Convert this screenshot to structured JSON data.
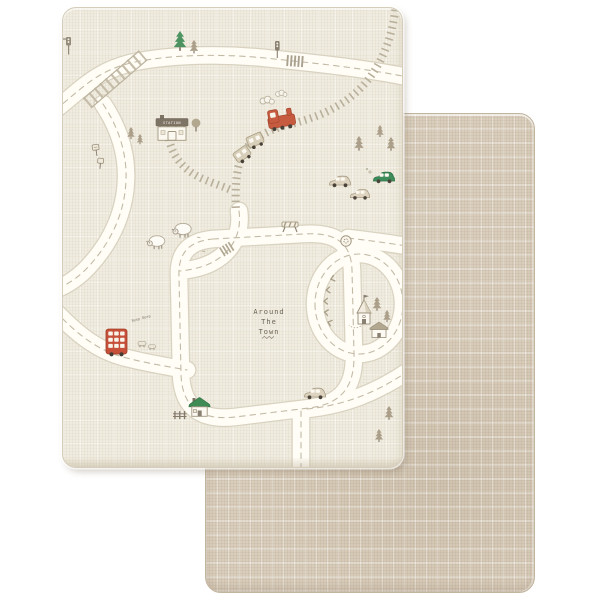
{
  "photo": {
    "subject": "double-sided baby play mat product photo",
    "front_side": "town road-map print",
    "back_side": "plain linen texture"
  },
  "mat_text": {
    "title_line1": "Around",
    "title_line2": "The",
    "title_line3": "Town",
    "station_sign": "STATION",
    "bus_caption": "Beep Beep"
  },
  "palette": {
    "page_bg": "#ffffff",
    "front_mat": "#f0ecdf",
    "back_mat": "#d9cdbb",
    "road_fill": "#fffdf6",
    "road_outline": "#d9d2c0",
    "road_dash": "#c3baa6",
    "railway": "#b9b09c",
    "taupe_detail": "#a29780",
    "accent_red": "#c6503a",
    "accent_green": "#3e8c5a",
    "text_brown": "#6b6356"
  },
  "motifs": [
    "roads",
    "railway",
    "railway-bridge",
    "steam-train",
    "train-wagons",
    "steam-clouds",
    "station",
    "round-tree",
    "pine-trees",
    "traffic-lights",
    "road-signs",
    "sheep",
    "crosswalks",
    "roadworks-barrier",
    "roundabout-sign",
    "double-decker-bus",
    "cars",
    "green-roof-house",
    "fence",
    "church",
    "cottage",
    "chevron-arrows",
    "title-lettering"
  ]
}
